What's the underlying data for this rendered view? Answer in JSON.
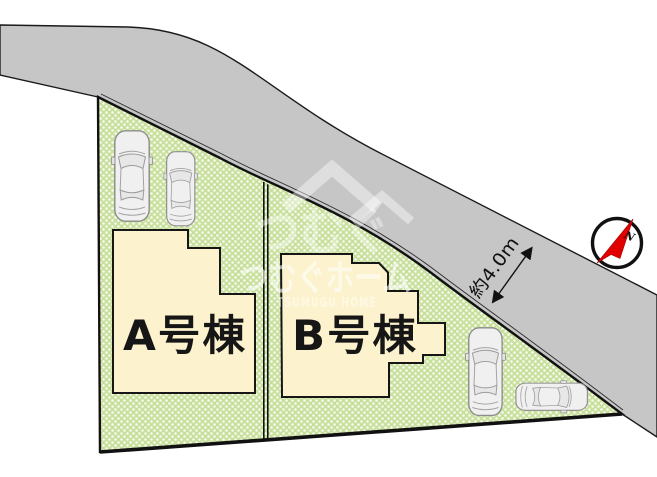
{
  "site_plan": {
    "buildings": [
      {
        "label": "A号棟"
      },
      {
        "label": "B号棟"
      }
    ],
    "road": {
      "width_label": "約4.0m"
    },
    "compass": {
      "north_label": "N"
    },
    "watermark": {
      "logo_text": "つむぐ",
      "brand_jp": "つむぐホーム",
      "brand_en": "TSUMUGU HOME"
    },
    "colors": {
      "road_gray": "#c6c6c6",
      "lot_green": "#cde4a4",
      "building_cream": "#fcf2cd",
      "outline_black": "#1a1a1a",
      "compass_red": "#e00000"
    },
    "cars_visible": 4
  }
}
